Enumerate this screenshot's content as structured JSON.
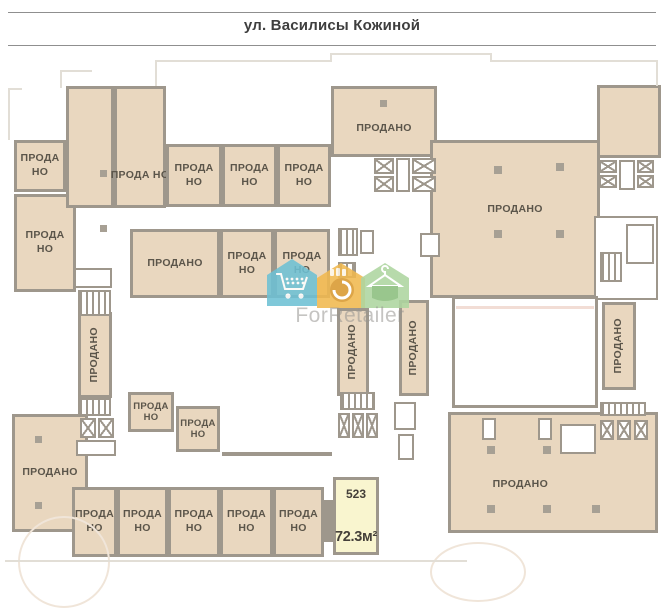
{
  "header": {
    "street_label": "ул. Василисы Кожиной"
  },
  "watermark": {
    "brand": "ForRetailer",
    "icon_colors": {
      "cart_house": "#6ec1d4",
      "basket_house": "#f1b94f",
      "hanger_house": "#aed6a0"
    }
  },
  "selected_unit": {
    "number": "523",
    "area": "72.3м²"
  },
  "status_labels": {
    "sold_one_line": "ПРОДАНО",
    "sold_two_line": "ПРОДА НО"
  },
  "palette": {
    "unit_fill": "#e9d7bf",
    "wall": "#9e978c",
    "label_text": "#5b554a",
    "highlight_fill": "#f9f5cf",
    "outline_light": "#e2ded6"
  },
  "units": [
    {
      "id": "left-top",
      "label": "ПРОДА НО",
      "x": 14,
      "y": 140,
      "w": 52,
      "h": 52
    },
    {
      "id": "left-mid",
      "label": "ПРОДА НО",
      "x": 14,
      "y": 194,
      "w": 62,
      "h": 98
    },
    {
      "id": "tall-1",
      "label": "",
      "x": 66,
      "y": 86,
      "w": 48,
      "h": 122
    },
    {
      "id": "tall-2",
      "label": "ПРОДА НО",
      "x": 114,
      "y": 86,
      "w": 52,
      "h": 122,
      "ly": 75
    },
    {
      "id": "top-row-1",
      "label": "ПРОДА НО",
      "x": 166,
      "y": 144,
      "w": 56,
      "h": 63
    },
    {
      "id": "top-row-2",
      "label": "ПРОДА НО",
      "x": 222,
      "y": 144,
      "w": 55,
      "h": 63
    },
    {
      "id": "top-row-3",
      "label": "ПРОДА НО",
      "x": 277,
      "y": 144,
      "w": 54,
      "h": 63
    },
    {
      "id": "top-center",
      "label": "ПРОДАНО",
      "x": 331,
      "y": 86,
      "w": 106,
      "h": 71,
      "ly": 62
    },
    {
      "id": "mid-row-wide",
      "label": "ПРОДАНО",
      "x": 130,
      "y": 229,
      "w": 90,
      "h": 69
    },
    {
      "id": "mid-row-2",
      "label": "ПРОДА НО",
      "x": 220,
      "y": 229,
      "w": 54,
      "h": 69
    },
    {
      "id": "mid-row-3",
      "label": "ПРОДА НО",
      "x": 274,
      "y": 229,
      "w": 56,
      "h": 69
    },
    {
      "id": "right-top-big",
      "label": "ПРОДАНО",
      "x": 430,
      "y": 140,
      "w": 170,
      "h": 158,
      "ly": 44
    },
    {
      "id": "right-annex",
      "label": "",
      "x": 597,
      "y": 85,
      "w": 64,
      "h": 73
    },
    {
      "id": "vert-left",
      "label": "ПРОДАНО",
      "x": 78,
      "y": 312,
      "w": 34,
      "h": 86,
      "v": 1
    },
    {
      "id": "vert-center-1",
      "label": "ПРОДАНО",
      "x": 337,
      "y": 308,
      "w": 32,
      "h": 88,
      "v": 1
    },
    {
      "id": "vert-center-2",
      "label": "ПРОДАНО",
      "x": 399,
      "y": 300,
      "w": 30,
      "h": 96,
      "v": 1
    },
    {
      "id": "vert-right",
      "label": "ПРОДАНО",
      "x": 602,
      "y": 302,
      "w": 34,
      "h": 88,
      "v": 1
    },
    {
      "id": "bottom-left-big",
      "label": "ПРОДАНО",
      "x": 12,
      "y": 414,
      "w": 76,
      "h": 118
    },
    {
      "id": "small-1",
      "label": "ПРОДА НО",
      "x": 128,
      "y": 392,
      "w": 46,
      "h": 40,
      "small": 1
    },
    {
      "id": "small-2",
      "label": "ПРОДА НО",
      "x": 176,
      "y": 406,
      "w": 44,
      "h": 46,
      "small": 1
    },
    {
      "id": "bottom-row-1",
      "label": "ПРОДА НО",
      "x": 72,
      "y": 487,
      "w": 45,
      "h": 70
    },
    {
      "id": "bottom-row-2",
      "label": "ПРОДА НО",
      "x": 117,
      "y": 487,
      "w": 51,
      "h": 70
    },
    {
      "id": "bottom-row-3",
      "label": "ПРОДА НО",
      "x": 168,
      "y": 487,
      "w": 52,
      "h": 70
    },
    {
      "id": "bottom-row-4",
      "label": "ПРОДА НО",
      "x": 220,
      "y": 487,
      "w": 53,
      "h": 70
    },
    {
      "id": "bottom-row-5",
      "label": "ПРОДА НО",
      "x": 273,
      "y": 487,
      "w": 51,
      "h": 70
    },
    {
      "id": "bottom-right-big",
      "label": "ПРОДАНО",
      "x": 448,
      "y": 412,
      "w": 210,
      "h": 121,
      "lx": 34,
      "ly": 61
    }
  ],
  "details": [
    {
      "t": "elev",
      "x": 374,
      "y": 158,
      "w": 20,
      "h": 16
    },
    {
      "t": "elev",
      "x": 374,
      "y": 176,
      "w": 20,
      "h": 16
    },
    {
      "t": "room",
      "x": 396,
      "y": 158,
      "w": 14,
      "h": 34
    },
    {
      "t": "elev",
      "x": 412,
      "y": 158,
      "w": 24,
      "h": 16
    },
    {
      "t": "elev",
      "x": 412,
      "y": 176,
      "w": 24,
      "h": 16
    },
    {
      "t": "elev",
      "x": 599,
      "y": 160,
      "w": 18,
      "h": 13
    },
    {
      "t": "elev",
      "x": 599,
      "y": 175,
      "w": 18,
      "h": 13
    },
    {
      "t": "room",
      "x": 619,
      "y": 160,
      "w": 16,
      "h": 30
    },
    {
      "t": "elev",
      "x": 637,
      "y": 160,
      "w": 17,
      "h": 13
    },
    {
      "t": "elev",
      "x": 637,
      "y": 175,
      "w": 17,
      "h": 13
    },
    {
      "t": "room",
      "x": 594,
      "y": 216,
      "w": 64,
      "h": 84
    },
    {
      "t": "stair",
      "x": 600,
      "y": 252,
      "w": 22,
      "h": 30
    },
    {
      "t": "room",
      "x": 626,
      "y": 224,
      "w": 28,
      "h": 40
    },
    {
      "t": "room",
      "x": 74,
      "y": 268,
      "w": 38,
      "h": 20
    },
    {
      "t": "stair",
      "x": 78,
      "y": 290,
      "w": 33,
      "h": 26
    },
    {
      "t": "stair",
      "x": 78,
      "y": 398,
      "w": 33,
      "h": 18
    },
    {
      "t": "elev",
      "x": 80,
      "y": 418,
      "w": 16,
      "h": 20
    },
    {
      "t": "elev",
      "x": 98,
      "y": 418,
      "w": 16,
      "h": 20
    },
    {
      "t": "room",
      "x": 76,
      "y": 440,
      "w": 40,
      "h": 16
    },
    {
      "t": "stair",
      "x": 340,
      "y": 392,
      "w": 35,
      "h": 18
    },
    {
      "t": "elev",
      "x": 338,
      "y": 413,
      "w": 12,
      "h": 25
    },
    {
      "t": "elev",
      "x": 352,
      "y": 413,
      "w": 12,
      "h": 25
    },
    {
      "t": "elev",
      "x": 366,
      "y": 413,
      "w": 12,
      "h": 25
    },
    {
      "t": "room",
      "x": 394,
      "y": 402,
      "w": 22,
      "h": 28
    },
    {
      "t": "room",
      "x": 398,
      "y": 434,
      "w": 16,
      "h": 26
    },
    {
      "t": "stair",
      "x": 338,
      "y": 228,
      "w": 20,
      "h": 28
    },
    {
      "t": "room",
      "x": 360,
      "y": 230,
      "w": 14,
      "h": 24
    },
    {
      "t": "stair",
      "x": 338,
      "y": 262,
      "w": 18,
      "h": 16
    },
    {
      "t": "room",
      "x": 420,
      "y": 233,
      "w": 20,
      "h": 24
    },
    {
      "t": "stair",
      "x": 600,
      "y": 402,
      "w": 46,
      "h": 14
    },
    {
      "t": "elev",
      "x": 600,
      "y": 420,
      "w": 14,
      "h": 20
    },
    {
      "t": "elev",
      "x": 617,
      "y": 420,
      "w": 14,
      "h": 20
    },
    {
      "t": "elev",
      "x": 634,
      "y": 420,
      "w": 14,
      "h": 20
    },
    {
      "t": "room",
      "x": 560,
      "y": 424,
      "w": 36,
      "h": 30
    },
    {
      "t": "void",
      "x": 452,
      "y": 296,
      "w": 146,
      "h": 112
    },
    {
      "t": "pink",
      "x": 456,
      "y": 306,
      "w": 138,
      "h": 3
    },
    {
      "t": "wall",
      "x": 324,
      "y": 500,
      "w": 10,
      "h": 42
    },
    {
      "t": "wall",
      "x": 222,
      "y": 452,
      "w": 110,
      "h": 4
    },
    {
      "t": "col",
      "x": 494,
      "y": 166,
      "w": 8,
      "h": 8
    },
    {
      "t": "col",
      "x": 556,
      "y": 163,
      "w": 8,
      "h": 8
    },
    {
      "t": "col",
      "x": 494,
      "y": 230,
      "w": 8,
      "h": 8
    },
    {
      "t": "col",
      "x": 556,
      "y": 230,
      "w": 8,
      "h": 8
    },
    {
      "t": "col",
      "x": 487,
      "y": 446,
      "w": 8,
      "h": 8
    },
    {
      "t": "col",
      "x": 543,
      "y": 446,
      "w": 8,
      "h": 8
    },
    {
      "t": "col",
      "x": 487,
      "y": 505,
      "w": 8,
      "h": 8
    },
    {
      "t": "col",
      "x": 543,
      "y": 505,
      "w": 8,
      "h": 8
    },
    {
      "t": "col",
      "x": 592,
      "y": 505,
      "w": 8,
      "h": 8
    },
    {
      "t": "room",
      "x": 482,
      "y": 418,
      "w": 14,
      "h": 22
    },
    {
      "t": "room",
      "x": 538,
      "y": 418,
      "w": 14,
      "h": 22
    },
    {
      "t": "col",
      "x": 100,
      "y": 170,
      "w": 7,
      "h": 7
    },
    {
      "t": "col",
      "x": 100,
      "y": 225,
      "w": 7,
      "h": 7
    },
    {
      "t": "col",
      "x": 35,
      "y": 436,
      "w": 7,
      "h": 7
    },
    {
      "t": "col",
      "x": 35,
      "y": 502,
      "w": 7,
      "h": 7
    },
    {
      "t": "col",
      "x": 380,
      "y": 100,
      "w": 7,
      "h": 7
    },
    {
      "t": "outline",
      "x": 155,
      "y": 60,
      "w": 177,
      "h": 2
    },
    {
      "t": "outline",
      "x": 330,
      "y": 53,
      "w": 162,
      "h": 2
    },
    {
      "t": "outline",
      "x": 330,
      "y": 53,
      "w": 2,
      "h": 9
    },
    {
      "t": "outline",
      "x": 490,
      "y": 53,
      "w": 2,
      "h": 9
    },
    {
      "t": "outline",
      "x": 490,
      "y": 60,
      "w": 168,
      "h": 2
    },
    {
      "t": "outline",
      "x": 155,
      "y": 60,
      "w": 2,
      "h": 26
    },
    {
      "t": "outline",
      "x": 656,
      "y": 60,
      "w": 2,
      "h": 26
    },
    {
      "t": "outline",
      "x": 8,
      "y": 88,
      "w": 2,
      "h": 52
    },
    {
      "t": "outline",
      "x": 8,
      "y": 88,
      "w": 14,
      "h": 2
    },
    {
      "t": "outline",
      "x": 60,
      "y": 70,
      "w": 32,
      "h": 2
    },
    {
      "t": "outline",
      "x": 60,
      "y": 70,
      "w": 2,
      "h": 18
    },
    {
      "t": "arc",
      "x": 18,
      "y": 516,
      "w": 92,
      "h": 92
    },
    {
      "t": "arc",
      "x": 430,
      "y": 542,
      "w": 96,
      "h": 60
    },
    {
      "t": "outline",
      "x": 5,
      "y": 560,
      "w": 462,
      "h": 2
    }
  ]
}
